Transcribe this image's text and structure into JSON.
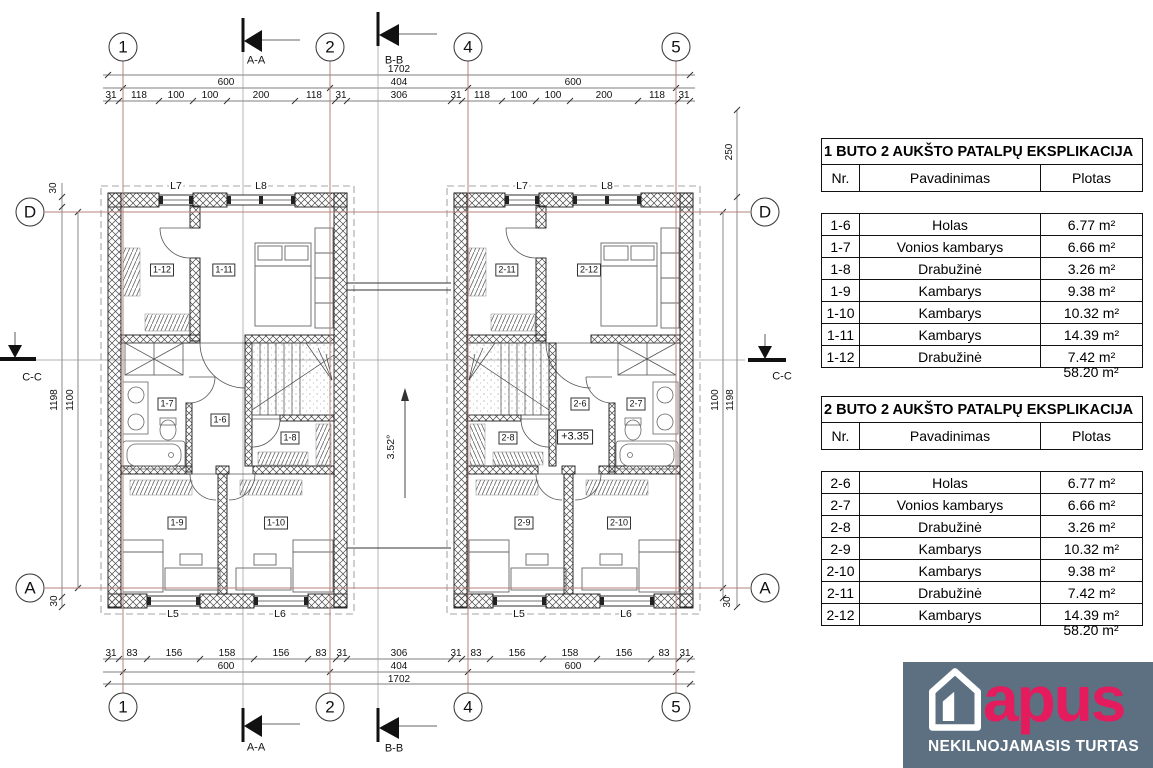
{
  "plan": {
    "grid_top": [
      "1",
      "2",
      "4",
      "5"
    ],
    "grid_bottom": [
      "1",
      "2",
      "4",
      "5"
    ],
    "grid_left": [
      "D",
      "A"
    ],
    "grid_right": [
      "D",
      "A"
    ],
    "sections": {
      "aa": "A-A",
      "bb": "B-B",
      "cc": "C-C"
    },
    "dims": {
      "top_total": "1702",
      "top_mid": [
        "600",
        "404",
        "600"
      ],
      "top_left": [
        "31",
        "118",
        "100",
        "100",
        "200",
        "118",
        "31"
      ],
      "top_center": "306",
      "top_right": [
        "31",
        "118",
        "100",
        "100",
        "200",
        "118",
        "31"
      ],
      "bottom_left": [
        "31",
        "83",
        "156",
        "158",
        "156",
        "83",
        "31"
      ],
      "bottom_center": "306",
      "bottom_right": [
        "31",
        "83",
        "156",
        "158",
        "156",
        "83",
        "31"
      ],
      "bottom_mid": [
        "600",
        "404",
        "600"
      ],
      "bottom_total": "1702",
      "left_top_30": "30",
      "left_1198": "1198",
      "left_1100": "1100",
      "left_bottom_30": "30",
      "right_250": "250",
      "right_1100": "1100",
      "right_1198": "1198",
      "right_bottom_30": "30"
    },
    "unit1": {
      "rooms": {
        "r12": "1-12",
        "r11": "1-11",
        "r7": "1-7",
        "r6": "1-6",
        "r8": "1-8",
        "r9": "1-9",
        "r10": "1-10"
      },
      "windows": {
        "l7": "L7",
        "l8": "L8",
        "l5": "L5",
        "l6": "L6"
      }
    },
    "unit2": {
      "rooms": {
        "r11": "2-11",
        "r12": "2-12",
        "r8": "2-8",
        "r6": "2-6",
        "r7": "2-7",
        "r9": "2-9",
        "r10": "2-10"
      },
      "windows": {
        "l7": "L7",
        "l8": "L8",
        "l5": "L5",
        "l6": "L6"
      },
      "elevation": "+3.35"
    },
    "slope": "3.52°"
  },
  "tables": [
    {
      "title": "1 BUTO 2 AUKŠTO PATALPŲ EKSPLIKACIJA",
      "headers": [
        "Nr.",
        "Pavadinimas",
        "Plotas"
      ],
      "rows": [
        [
          "1-6",
          "Holas",
          "6.77 m²"
        ],
        [
          "1-7",
          "Vonios kambarys",
          "6.66 m²"
        ],
        [
          "1-8",
          "Drabužinė",
          "3.26 m²"
        ],
        [
          "1-9",
          "Kambarys",
          "9.38 m²"
        ],
        [
          "1-10",
          "Kambarys",
          "10.32 m²"
        ],
        [
          "1-11",
          "Kambarys",
          "14.39 m²"
        ],
        [
          "1-12",
          "Drabužinė",
          "7.42 m²"
        ]
      ],
      "total": "58.20 m²"
    },
    {
      "title": "2 BUTO 2 AUKŠTO PATALPŲ EKSPLIKACIJA",
      "headers": [
        "Nr.",
        "Pavadinimas",
        "Plotas"
      ],
      "rows": [
        [
          "2-6",
          "Holas",
          "6.77 m²"
        ],
        [
          "2-7",
          "Vonios kambarys",
          "6.66 m²"
        ],
        [
          "2-8",
          "Drabužinė",
          "3.26 m²"
        ],
        [
          "2-9",
          "Kambarys",
          "10.32 m²"
        ],
        [
          "2-10",
          "Kambarys",
          "9.38 m²"
        ],
        [
          "2-11",
          "Drabužinė",
          "7.42 m²"
        ],
        [
          "2-12",
          "Kambarys",
          "14.39 m²"
        ]
      ],
      "total": "58.20 m²"
    }
  ],
  "logo": {
    "name": "apus",
    "tagline": "NEKILNOJAMASIS TURTAS",
    "brand_color": "#e41b5c",
    "bg_color": "#5c7082"
  }
}
